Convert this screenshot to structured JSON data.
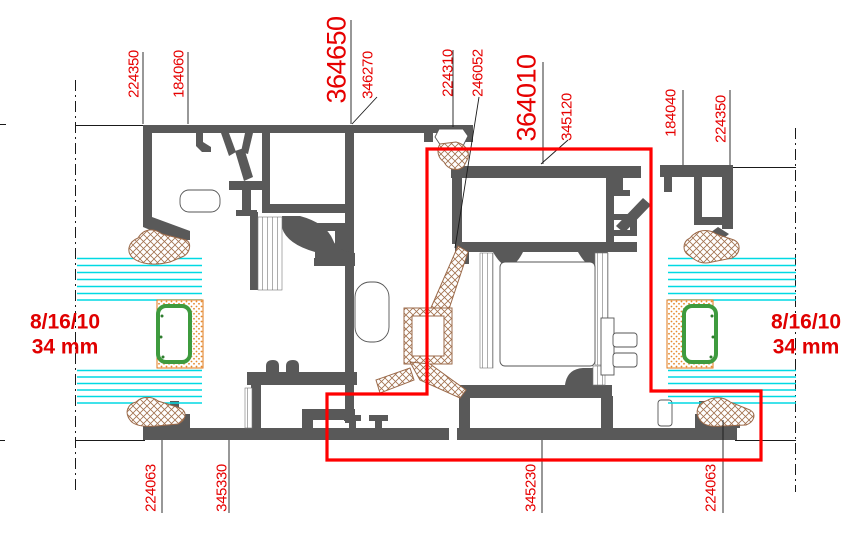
{
  "drawing": {
    "type": "aluminium-window-profile-cross-section",
    "labels_top": [
      {
        "text": "224350",
        "size": "small"
      },
      {
        "text": "184060",
        "size": "small"
      },
      {
        "text": "364650",
        "size": "big"
      },
      {
        "text": "346270",
        "size": "small"
      },
      {
        "text": "224310",
        "size": "small"
      },
      {
        "text": "246052",
        "size": "small"
      },
      {
        "text": "364010",
        "size": "big"
      },
      {
        "text": "345120",
        "size": "small"
      },
      {
        "text": "184040",
        "size": "small"
      },
      {
        "text": "224350",
        "size": "small"
      }
    ],
    "labels_bottom": [
      {
        "text": "224063"
      },
      {
        "text": "345330"
      },
      {
        "text": "345230"
      },
      {
        "text": "224063"
      }
    ],
    "glazing_note_left": {
      "line1": "8/16/10",
      "line2": "34 mm"
    },
    "glazing_note_right": {
      "line1": "8/16/10",
      "line2": "34 mm"
    },
    "colors": {
      "profile_gray": "#595959",
      "highlight_red": "#ff0000",
      "label_red": "#e60000",
      "glass_cyan": "#00d9e3",
      "spacer_green": "#3e9b3e",
      "sealant_orange": "#e07818",
      "gasket_brown": "#9b6a4a"
    }
  }
}
